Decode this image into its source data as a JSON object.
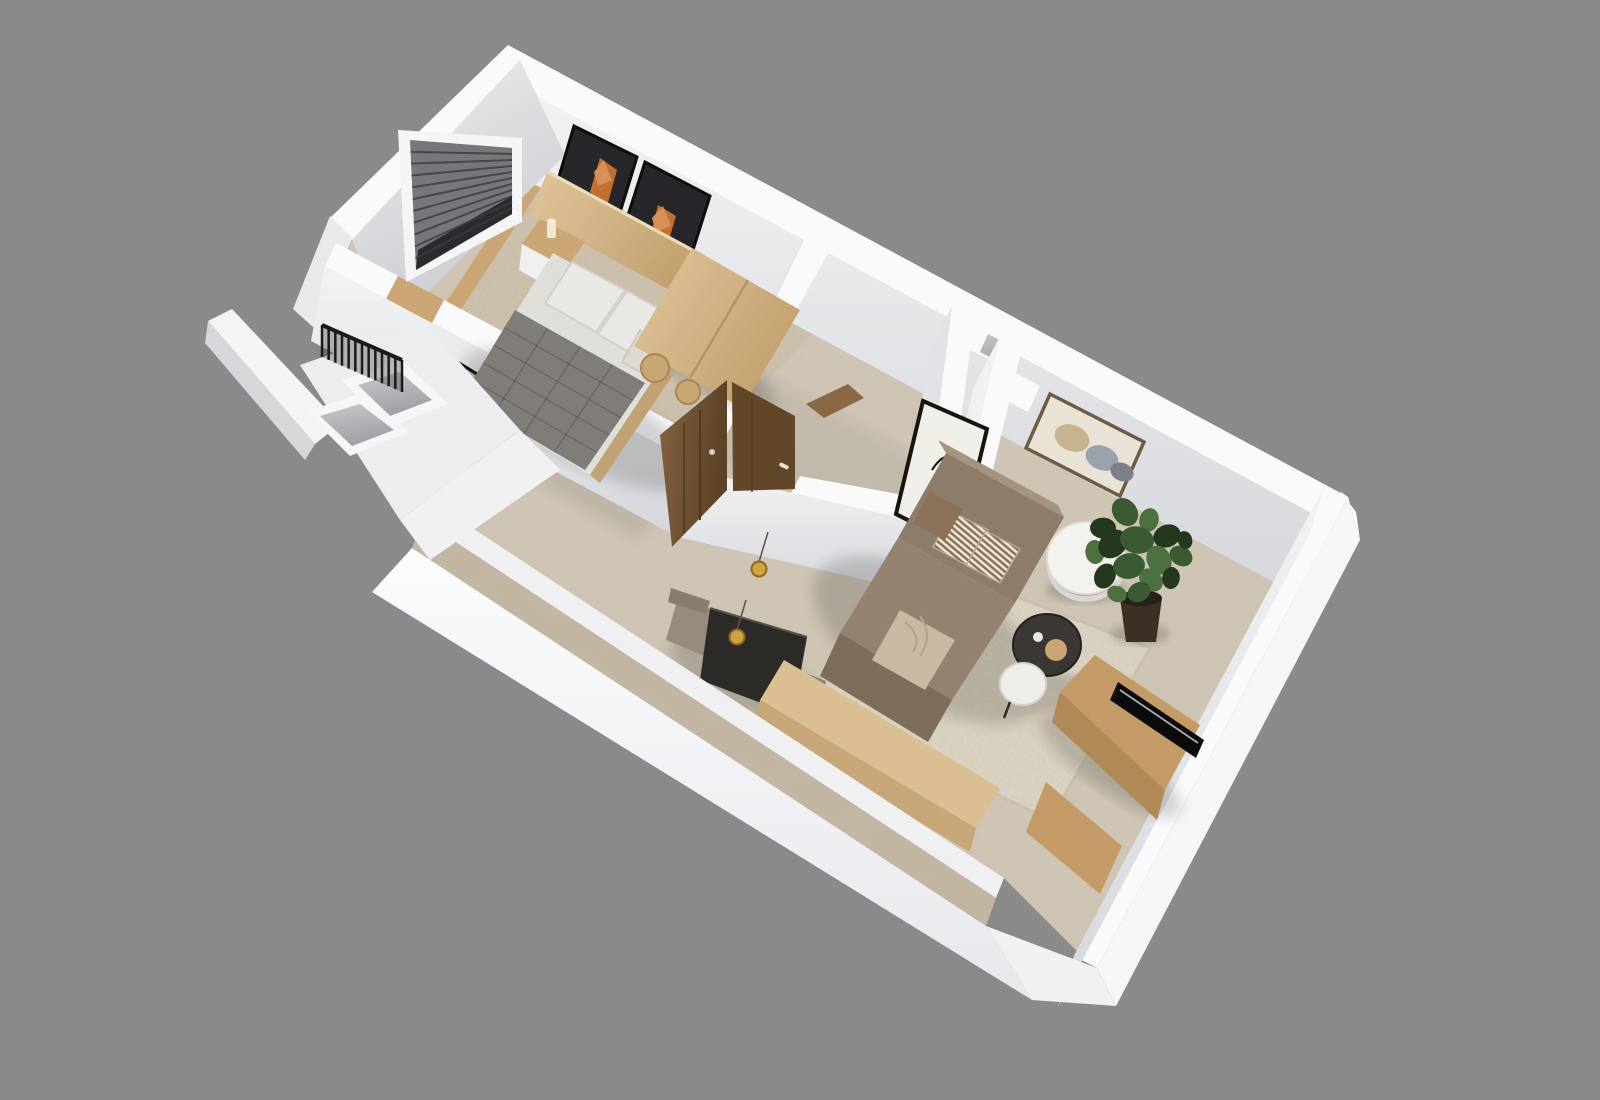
{
  "scene": {
    "description": "3D cutaway floor plan render of a one-bedroom apartment viewed from above at an angle",
    "background": "#8a8a8a",
    "canvas": {
      "width": 1600,
      "height": 1100
    }
  },
  "colors": {
    "bg": "#8a8a8a",
    "wallTop": "#fafafc",
    "wallTopShade": "#e9e9ec",
    "faceLight": "#f0f1f3",
    "faceMid": "#e2e3e6",
    "faceShade": "#cfd0d4",
    "outerFace": "#f5f6f8",
    "marble": "#cfc6b6",
    "marbleEdge": "#c0b4a0",
    "carpet": "#cec2ae",
    "rug": "#ddd5c3",
    "woodLight": "#dcc096",
    "woodMid": "#c9a674",
    "woodDark": "#8a6844",
    "doorWood": "#77573a",
    "doorWoodDark": "#624628",
    "headboard": "#c1a274",
    "sofa": "#8d7c69",
    "sofaLight": "#a4937e",
    "sofaDark": "#7d6d5b",
    "throw": "#c9b8a2",
    "quilt": "#807c77",
    "duvet": "#e0ded9",
    "pillow": "#eae8e4",
    "nightstand": "#eef0f2",
    "tableBlack": "#2d2b28",
    "tableWhite": "#f3f2ef",
    "benchWood": "#dabf92",
    "consoleWood": "#c49b66",
    "tvBlack": "#0b0b0d",
    "gold": "#cfa13f",
    "goldDark": "#8a6820",
    "plantDark": "#23381d",
    "plantMid": "#3a5a33",
    "plantLight": "#4d7040",
    "pot": "#3c2f24",
    "mirrorGlass": "#b5ad9e",
    "frameDark": "#17140f",
    "artPanel": "#26262b",
    "artOrange": "#c2702f",
    "artOrangeLight": "#d89058",
    "artCanvas": "#e9e3d5",
    "artBeige": "#c8b391",
    "artGrayBlue": "#9aa3ad",
    "artGray": "#7b7f88",
    "blinds": "#77777b",
    "blindsDark": "#2b2b2f",
    "railing": "#1a1a1d",
    "shaftInner": "#b9bbbf",
    "shadow": "#000000"
  },
  "details": {
    "blinds": {
      "slats": 10
    },
    "railing": {
      "slats": 12
    },
    "quilt": {
      "rows": 5,
      "cols": 4
    },
    "plant": {
      "leaves": [
        [
          -38,
          -72,
          13
        ],
        [
          -16,
          -88,
          15
        ],
        [
          8,
          -80,
          12
        ],
        [
          26,
          -64,
          14
        ],
        [
          40,
          -44,
          12
        ],
        [
          -46,
          -48,
          12
        ],
        [
          -28,
          -56,
          16
        ],
        [
          -4,
          -60,
          17
        ],
        [
          18,
          -40,
          15
        ],
        [
          -36,
          -24,
          13
        ],
        [
          -12,
          -34,
          16
        ],
        [
          10,
          -20,
          13
        ],
        [
          30,
          -22,
          11
        ],
        [
          -2,
          -8,
          12
        ],
        [
          -24,
          -6,
          10
        ],
        [
          44,
          -60,
          9
        ]
      ]
    }
  },
  "inventory": {
    "rooms": [
      {
        "name": "bedroom",
        "items": [
          "double-bed",
          "gray-quilt",
          "pillows",
          "nightstand",
          "candle",
          "headboard-panel",
          "framed-art-pair",
          "window-blinds",
          "wardrobe-closet",
          "wood-stools"
        ]
      },
      {
        "name": "bathroom",
        "items": [
          "marble-floor",
          "service-niche"
        ]
      },
      {
        "name": "hallway",
        "items": [
          "entry-double-door",
          "leaning-floor-mirror",
          "marble-floor"
        ]
      },
      {
        "name": "dining-area",
        "items": [
          "black-dining-table",
          "upholstered-chairs",
          "gold-pendant-lamps",
          "wood-bench"
        ]
      },
      {
        "name": "living-room",
        "items": [
          "l-shaped-sofa",
          "patterned-cushions",
          "throw-blanket",
          "white-side-table",
          "round-coffee-table",
          "nesting-table",
          "potted-plant",
          "tv-console",
          "flat-tv",
          "abstract-wall-art",
          "botanical-sketch-art",
          "area-rug"
        ]
      },
      {
        "name": "stairwell-balcony",
        "items": [
          "dark-railing",
          "shaft-openings",
          "parapet-walls"
        ]
      }
    ]
  }
}
